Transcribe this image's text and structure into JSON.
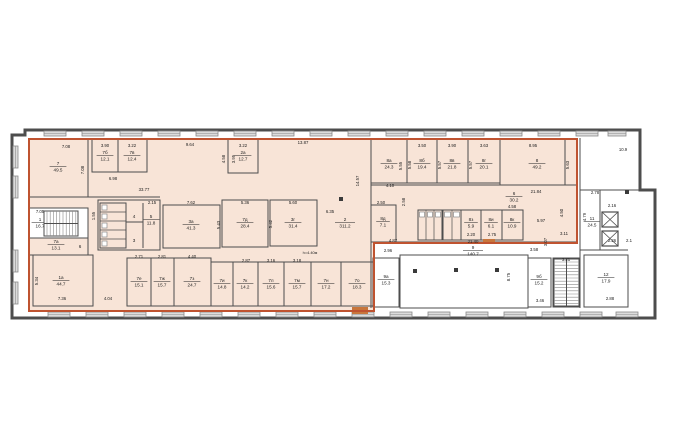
{
  "title": "floor-plan",
  "colors": {
    "bg": "#ffffff",
    "wall": "#4d4d4d",
    "thin": "#8a8a8a",
    "peach": "#f8e4d7",
    "highlight": "#bf5330",
    "window_fill": "#dcdcdc",
    "door": "#c8763c",
    "ink": "#222222",
    "column": "#3a3a3a"
  },
  "canvas": {
    "w": 681,
    "h": 444
  },
  "building": {
    "outline": "25,130 640,130 640,190 655,190 655,318 12,318 12,135 25,135",
    "highlight_points": "29,139 577,139 577,243 374,243 374,311 29,311"
  },
  "windows": {
    "top": [
      [
        44,
        131,
        22,
        5
      ],
      [
        82,
        131,
        22,
        5
      ],
      [
        120,
        131,
        22,
        5
      ],
      [
        158,
        131,
        22,
        5
      ],
      [
        196,
        131,
        22,
        5
      ],
      [
        234,
        131,
        22,
        5
      ],
      [
        272,
        131,
        22,
        5
      ],
      [
        310,
        131,
        22,
        5
      ],
      [
        348,
        131,
        22,
        5
      ],
      [
        386,
        131,
        22,
        5
      ],
      [
        424,
        131,
        22,
        5
      ],
      [
        462,
        131,
        22,
        5
      ],
      [
        500,
        131,
        22,
        5
      ],
      [
        538,
        131,
        22,
        5
      ],
      [
        576,
        131,
        22,
        5
      ],
      [
        608,
        131,
        18,
        5
      ]
    ],
    "bottom": [
      [
        48,
        312,
        22,
        5
      ],
      [
        86,
        312,
        22,
        5
      ],
      [
        124,
        312,
        22,
        5
      ],
      [
        162,
        312,
        22,
        5
      ],
      [
        200,
        312,
        22,
        5
      ],
      [
        238,
        312,
        22,
        5
      ],
      [
        276,
        312,
        22,
        5
      ],
      [
        314,
        312,
        22,
        5
      ],
      [
        352,
        312,
        22,
        5
      ],
      [
        390,
        312,
        22,
        5
      ],
      [
        428,
        312,
        22,
        5
      ],
      [
        466,
        312,
        22,
        5
      ],
      [
        504,
        312,
        22,
        5
      ],
      [
        542,
        312,
        22,
        5
      ],
      [
        580,
        312,
        22,
        5
      ],
      [
        616,
        312,
        22,
        5
      ]
    ],
    "left": [
      [
        13,
        146,
        5,
        22
      ],
      [
        13,
        176,
        5,
        22
      ],
      [
        13,
        250,
        5,
        22
      ],
      [
        13,
        282,
        5,
        22
      ]
    ]
  },
  "rooms": [
    {
      "num": "7",
      "area": "49.5",
      "x": 29,
      "y": 139,
      "w": 59,
      "h": 58,
      "lx": 58,
      "ly": 166
    },
    {
      "num": "7б",
      "area": "12.1",
      "x": 92,
      "y": 139,
      "w": 26,
      "h": 33,
      "lx": 105,
      "ly": 155
    },
    {
      "num": "7в",
      "area": "12.4",
      "x": 118,
      "y": 139,
      "w": 29,
      "h": 33,
      "lx": 132,
      "ly": 155
    },
    {
      "num": "2а",
      "area": "12.7",
      "x": 228,
      "y": 139,
      "w": 30,
      "h": 34,
      "lx": 243,
      "ly": 155
    },
    {
      "x": 98,
      "y": 200,
      "w": 62,
      "h": 50
    },
    {
      "num": "5",
      "area": "11.8",
      "lx": 151,
      "ly": 219,
      "norect": true
    },
    {
      "num": "3а",
      "area": "41.3",
      "x": 163,
      "y": 205,
      "w": 57,
      "h": 43,
      "lx": 191,
      "ly": 224
    },
    {
      "num": "7д",
      "area": "28.4",
      "x": 222,
      "y": 200,
      "w": 46,
      "h": 47,
      "lx": 245,
      "ly": 222
    },
    {
      "num": "3г",
      "area": "31.4",
      "x": 270,
      "y": 200,
      "w": 47,
      "h": 46,
      "lx": 293,
      "ly": 222
    },
    {
      "num": "2",
      "area": "311.2",
      "norect": true,
      "lx": 345,
      "ly": 222
    },
    {
      "num": "1",
      "area": "16.7",
      "x": 29,
      "y": 208,
      "w": 59,
      "h": 30,
      "fill": "white",
      "lx": 40,
      "ly": 222
    },
    {
      "num": "7а",
      "area": "13.1",
      "x": 29,
      "y": 238,
      "w": 59,
      "h": 17,
      "lx": 56,
      "ly": 244
    },
    {
      "num": "1а",
      "area": "44.7",
      "x": 33,
      "y": 255,
      "w": 60,
      "h": 51,
      "lx": 61,
      "ly": 280
    },
    {
      "num": "7е",
      "area": "15.1",
      "x": 127,
      "y": 258,
      "w": 24,
      "h": 48,
      "lx": 139,
      "ly": 281
    },
    {
      "num": "7ж",
      "area": "15.7",
      "x": 151,
      "y": 258,
      "w": 23,
      "h": 48,
      "lx": 162,
      "ly": 281
    },
    {
      "num": "7з",
      "area": "24.7",
      "x": 174,
      "y": 258,
      "w": 37,
      "h": 48,
      "lx": 192,
      "ly": 281
    },
    {
      "num": "7и",
      "area": "14.8",
      "x": 211,
      "y": 262,
      "w": 22,
      "h": 44,
      "lx": 222,
      "ly": 283
    },
    {
      "num": "7к",
      "area": "14.2",
      "x": 233,
      "y": 262,
      "w": 25,
      "h": 44,
      "lx": 245,
      "ly": 283
    },
    {
      "num": "7л",
      "area": "15.6",
      "x": 258,
      "y": 262,
      "w": 26,
      "h": 44,
      "lx": 271,
      "ly": 283
    },
    {
      "num": "7м",
      "area": "15.7",
      "x": 284,
      "y": 262,
      "w": 27,
      "h": 44,
      "lx": 297,
      "ly": 283
    },
    {
      "num": "7н",
      "area": "17.2",
      "x": 311,
      "y": 262,
      "w": 30,
      "h": 44,
      "lx": 326,
      "ly": 283
    },
    {
      "num": "7о",
      "area": "18.3",
      "x": 341,
      "y": 262,
      "w": 33,
      "h": 44,
      "lx": 357,
      "ly": 283
    },
    {
      "num": "8а",
      "area": "24.3",
      "x": 371,
      "y": 139,
      "w": 36,
      "h": 44,
      "lx": 389,
      "ly": 163
    },
    {
      "num": "8б",
      "area": "19.4",
      "x": 407,
      "y": 139,
      "w": 30,
      "h": 44,
      "lx": 422,
      "ly": 163
    },
    {
      "num": "8в",
      "area": "21.8",
      "x": 437,
      "y": 139,
      "w": 31,
      "h": 44,
      "lx": 452,
      "ly": 163
    },
    {
      "num": "8г",
      "area": "20.1",
      "x": 468,
      "y": 139,
      "w": 32,
      "h": 44,
      "lx": 484,
      "ly": 163
    },
    {
      "num": "8",
      "area": "49.2",
      "x": 500,
      "y": 139,
      "w": 65,
      "h": 46,
      "lx": 537,
      "ly": 163
    },
    {
      "num": "6",
      "area": "30.2",
      "norect": true,
      "lx": 514,
      "ly": 196
    },
    {
      "num": "8д",
      "area": "7.1",
      "x": 371,
      "y": 205,
      "w": 25,
      "h": 37,
      "lx": 383,
      "ly": 221
    },
    {
      "num": "8з",
      "area": "5.9",
      "x": 461,
      "y": 210,
      "w": 20,
      "h": 30,
      "lx": 471,
      "ly": 222
    },
    {
      "num": "8и",
      "area": "6.1",
      "x": 481,
      "y": 210,
      "w": 21,
      "h": 30,
      "lx": 491,
      "ly": 222
    },
    {
      "num": "8к",
      "area": "10.9",
      "x": 502,
      "y": 210,
      "w": 21,
      "h": 30,
      "lx": 512,
      "ly": 222
    },
    {
      "num": "9",
      "area": "140.7",
      "x": 400,
      "y": 255,
      "w": 128,
      "h": 53,
      "fill": "white",
      "lx": 473,
      "ly": 250
    },
    {
      "num": "9а",
      "area": "15.3",
      "x": 373,
      "y": 258,
      "w": 26,
      "h": 49,
      "fill": "white",
      "lx": 386,
      "ly": 279
    },
    {
      "num": "9б",
      "area": "15.2",
      "x": 528,
      "y": 258,
      "w": 23,
      "h": 49,
      "fill": "white",
      "lx": 539,
      "ly": 279
    },
    {
      "num": "10",
      "area": "18.9",
      "x": 553,
      "y": 258,
      "w": 27,
      "h": 49,
      "fill": "white",
      "lx": 566,
      "ly": 266
    },
    {
      "num": "11",
      "area": "24.5",
      "norect": true,
      "lx": 592,
      "ly": 221
    },
    {
      "num": "12",
      "area": "17.9",
      "x": 584,
      "y": 255,
      "w": 44,
      "h": 52,
      "fill": "white",
      "lx": 606,
      "ly": 277
    }
  ],
  "plain_labels": [
    {
      "t": "4",
      "x": 134,
      "y": 218
    },
    {
      "t": "3",
      "x": 134,
      "y": 242
    },
    {
      "t": "6",
      "x": 80,
      "y": 248
    },
    {
      "t": "h=4.40м",
      "x": 310,
      "y": 254
    }
  ],
  "dims": [
    [
      "7.08",
      66,
      148,
      0
    ],
    [
      "7.08",
      84,
      170,
      1
    ],
    [
      "3.90",
      105,
      147,
      0
    ],
    [
      "3.22",
      132,
      147,
      0
    ],
    [
      "6.98",
      113,
      180,
      0
    ],
    [
      "9.64",
      190,
      146,
      0
    ],
    [
      "33.77",
      144,
      191,
      0
    ],
    [
      "3.22",
      243,
      147,
      0
    ],
    [
      "4.58",
      225,
      159,
      1
    ],
    [
      "3.95",
      235,
      159,
      1
    ],
    [
      "13.87",
      303,
      144,
      0
    ],
    [
      "14.57",
      359,
      181,
      1
    ],
    [
      "1.55",
      95,
      216,
      1
    ],
    [
      "2.15",
      152,
      204,
      0
    ],
    [
      "7.62",
      191,
      204,
      0
    ],
    [
      "5.43",
      220,
      225,
      1
    ],
    [
      "5.36",
      245,
      204,
      0
    ],
    [
      "5.42",
      272,
      224,
      1
    ],
    [
      "5.60",
      293,
      204,
      0
    ],
    [
      "6.35",
      330,
      213,
      0
    ],
    [
      "7.05",
      40,
      213,
      0
    ],
    [
      "5.34",
      38,
      281,
      1
    ],
    [
      "7.36",
      62,
      300,
      0
    ],
    [
      "4.04",
      108,
      300,
      0
    ],
    [
      "2.71",
      139,
      258,
      0
    ],
    [
      "2.81",
      162,
      258,
      0
    ],
    [
      "4.40",
      192,
      258,
      0
    ],
    [
      "2.87",
      246,
      262,
      0
    ],
    [
      "3.16",
      271,
      262,
      0
    ],
    [
      "3.18",
      297,
      262,
      0
    ],
    [
      "3.50",
      422,
      147,
      0
    ],
    [
      "3.90",
      452,
      147,
      0
    ],
    [
      "3.63",
      484,
      147,
      0
    ],
    [
      "8.95",
      533,
      147,
      0
    ],
    [
      "5.55",
      402,
      166,
      1
    ],
    [
      "5.58",
      411,
      165,
      1
    ],
    [
      "5.57",
      441,
      165,
      1
    ],
    [
      "5.57",
      472,
      165,
      1
    ],
    [
      "5.63",
      569,
      165,
      1
    ],
    [
      "4.10",
      390,
      187,
      0
    ],
    [
      "21.84",
      536,
      193,
      0
    ],
    [
      "2.58",
      405,
      202,
      1
    ],
    [
      "2.50",
      381,
      204,
      0
    ],
    [
      "2.20",
      471,
      236,
      0
    ],
    [
      "2.75",
      492,
      236,
      0
    ],
    [
      "4.58",
      512,
      208,
      0
    ],
    [
      "5.97",
      541,
      222,
      0
    ],
    [
      "4.50",
      563,
      213,
      1
    ],
    [
      "4.87",
      393,
      242,
      0
    ],
    [
      "2.96",
      388,
      252,
      0
    ],
    [
      "21.40",
      473,
      243,
      0
    ],
    [
      "8.75",
      510,
      277,
      1
    ],
    [
      "3.58",
      534,
      251,
      0
    ],
    [
      "3.46",
      540,
      302,
      0
    ],
    [
      "10.9",
      623,
      151,
      0
    ],
    [
      "2.78",
      595,
      194,
      0
    ],
    [
      "2.16",
      612,
      207,
      0
    ],
    [
      "2.26",
      612,
      242,
      0
    ],
    [
      "2.1",
      629,
      242,
      0
    ],
    [
      "4.79",
      586,
      217,
      1
    ],
    [
      "3.07",
      547,
      242,
      1
    ],
    [
      "3.11",
      564,
      235,
      0
    ],
    [
      "3.21",
      566,
      261,
      0
    ],
    [
      "2.88",
      610,
      300,
      0
    ]
  ],
  "walls": [
    [
      371,
      138,
      371,
      308
    ],
    [
      371,
      185,
      577,
      185
    ],
    [
      371,
      242,
      577,
      242
    ],
    [
      577,
      138,
      577,
      242
    ],
    [
      126,
      203,
      126,
      248
    ],
    [
      143,
      203,
      143,
      248
    ],
    [
      126,
      222,
      143,
      222
    ],
    [
      580,
      138,
      580,
      308
    ],
    [
      580,
      190,
      640,
      190
    ],
    [
      580,
      250,
      628,
      250
    ],
    [
      600,
      190,
      600,
      250
    ],
    [
      88,
      139,
      88,
      197
    ],
    [
      29,
      197,
      160,
      197
    ]
  ],
  "stairs": [
    {
      "x": 44,
      "y": 211,
      "w": 34,
      "h": 25,
      "dir": "v"
    },
    {
      "x": 554,
      "y": 259,
      "w": 25,
      "h": 47,
      "dir": "h"
    }
  ],
  "elevators": [
    {
      "x": 602,
      "y": 212,
      "w": 16,
      "h": 15
    },
    {
      "x": 602,
      "y": 231,
      "w": 16,
      "h": 15
    }
  ],
  "wc": [
    {
      "x": 100,
      "y": 203,
      "w": 26,
      "h": 45,
      "cells": 5,
      "dir": "v"
    },
    {
      "x": 418,
      "y": 210,
      "w": 24,
      "h": 30,
      "cells": 3,
      "dir": "h"
    },
    {
      "x": 443,
      "y": 210,
      "w": 18,
      "h": 30,
      "cells": 2,
      "dir": "h"
    }
  ],
  "columns": [
    [
      341,
      199
    ],
    [
      415,
      271
    ],
    [
      456,
      270
    ],
    [
      497,
      270
    ],
    [
      627,
      192
    ]
  ],
  "doors": [
    [
      352,
      307,
      16,
      7
    ],
    [
      483,
      239,
      12,
      5
    ]
  ]
}
